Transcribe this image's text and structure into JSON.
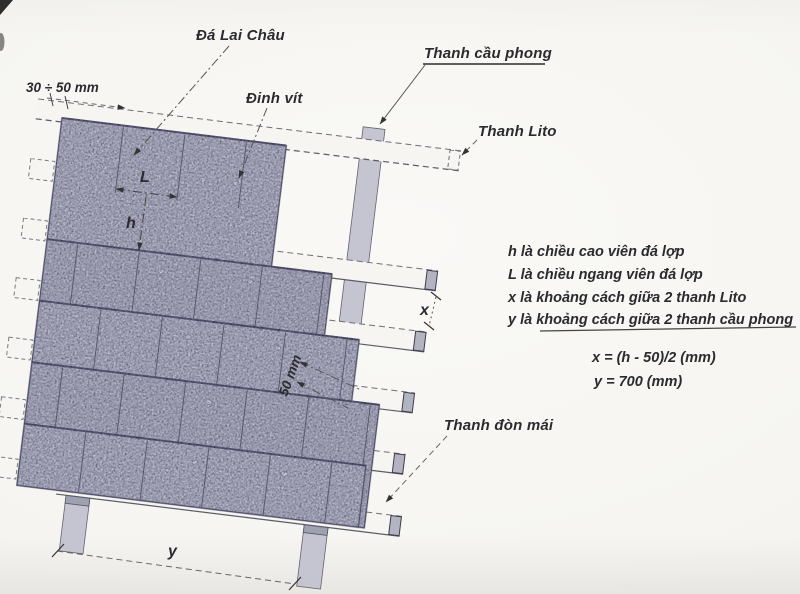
{
  "labels": {
    "da_lai_chau": "Đá Lai Châu",
    "dinh_vit": "Đinh vít",
    "thanh_cau_phong": "Thanh cầu phong",
    "thanh_lito": "Thanh Lito",
    "thanh_don_mai": "Thanh đòn mái",
    "dim_30_50": "30 ÷ 50 mm",
    "dim_50": "50 mm",
    "dim_h": "h",
    "dim_L": "L",
    "dim_x": "x",
    "dim_y": "y"
  },
  "legend": {
    "lines": [
      "h là chiều cao viên đá lợp",
      "L là chiều ngang viên đá lợp",
      "x là khoảng cách giữa 2 thanh Lito",
      "y là khoảng cách giữa 2 thanh cầu phong"
    ]
  },
  "formulas": {
    "x": "x = (h - 50)/2 (mm)",
    "y": "y = 700 (mm)"
  },
  "colors": {
    "paper": "#f8f7f4",
    "tile": "#cbccd9",
    "tile_alt": "#c6c7d4",
    "tile_edge": "#23263a",
    "joint": "#3f4357",
    "batten_face": "#f6f5f2",
    "batten_cap": "#b2b4c2",
    "rafter": "#c4c5d1",
    "rafter_cap": "#9ea1b2",
    "line": "#5b5b68",
    "dash": "#6e6e76",
    "ink": "#2b2b2f"
  }
}
